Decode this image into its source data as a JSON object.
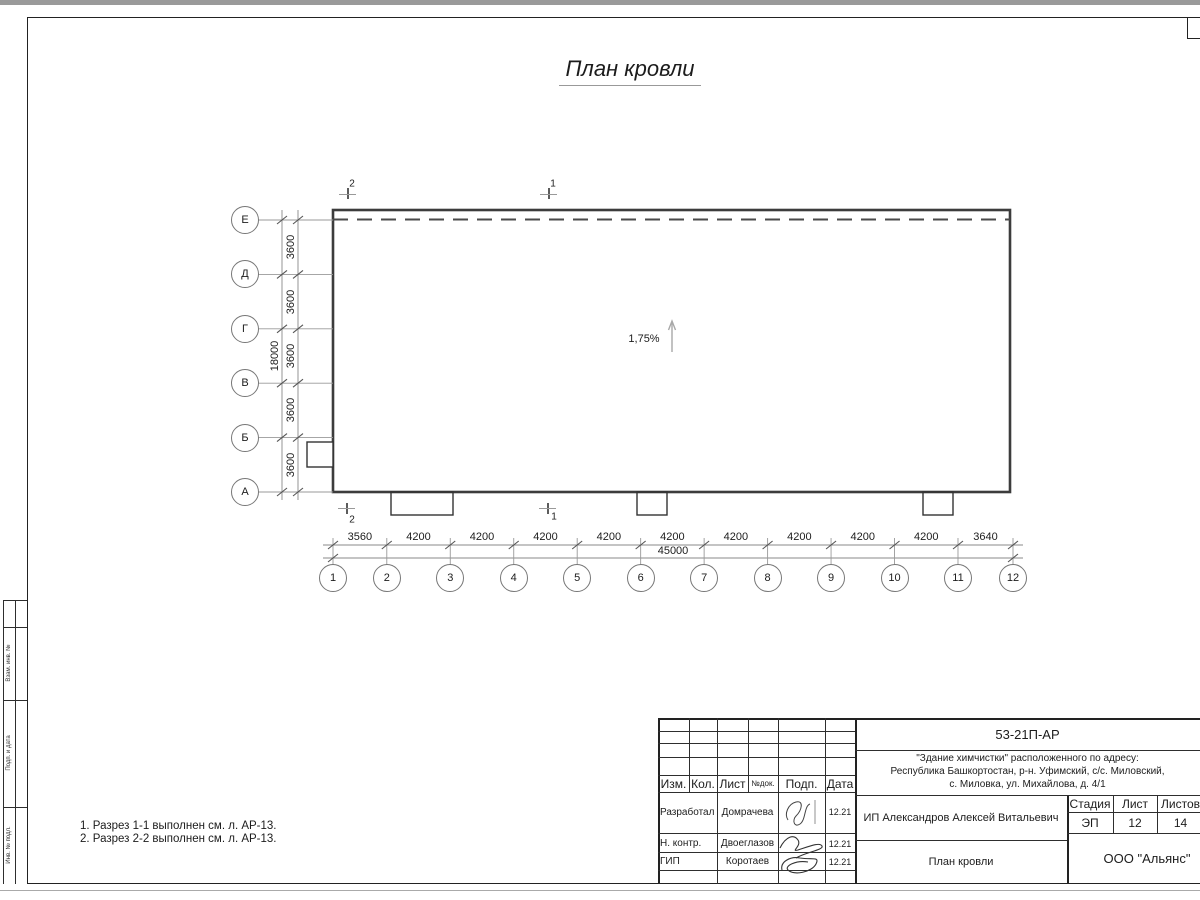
{
  "sheet": {
    "title": "План кровли",
    "notes": [
      "1. Разрез 1-1 выполнен см. л. АР-13.",
      "2. Разрез 2-2 выполнен см. л. АР-13."
    ]
  },
  "plan": {
    "slope_label": "1,75%",
    "section_top": [
      "2",
      "1"
    ],
    "section_bottom": [
      "2",
      "1"
    ],
    "row_axes": [
      "Е",
      "Д",
      "Г",
      "В",
      "Б",
      "А"
    ],
    "col_axes": [
      "1",
      "2",
      "3",
      "4",
      "5",
      "6",
      "7",
      "8",
      "9",
      "10",
      "11",
      "12"
    ],
    "row_dims": [
      "3600",
      "3600",
      "3600",
      "3600",
      "3600"
    ],
    "row_total": "18000",
    "col_dims": [
      "3560",
      "4200",
      "4200",
      "4200",
      "4200",
      "4200",
      "4200",
      "4200",
      "4200",
      "4200",
      "3640"
    ],
    "col_total": "45000"
  },
  "titleblock": {
    "doc_number": "53-21П-АР",
    "project": [
      "\"Здание химчистки\" расположенного по адресу:",
      "Республика Башкортостан, р-н. Уфимский, с/с. Миловский,",
      "с. Миловка, ул. Михайлова, д. 4/1"
    ],
    "columns": {
      "izm": "Изм.",
      "kol": "Кол.",
      "list": "Лист",
      "ndok": "№док.",
      "podp": "Подп.",
      "data": "Дата"
    },
    "rows": [
      {
        "role": "Разработал",
        "name": "Домрачева",
        "date": "12.21"
      },
      {
        "role": "Н. контр.",
        "name": "Двоеглазов",
        "date": "12.21"
      },
      {
        "role": "ГИП",
        "name": "Коротаев",
        "date": "12.21"
      }
    ],
    "client": "ИП Александров Алексей Витальевич",
    "stage_label": "Стадия",
    "sheet_label": "Лист",
    "sheets_label": "Листов",
    "stage": "ЭП",
    "sheet_no": "12",
    "sheets_total": "14",
    "drawing_title": "План кровли",
    "company": "ООО \"Альянс\""
  },
  "side_stamp": {
    "labels": [
      "Взам. инв. №",
      "Подп. и дата",
      "Инв. № подл."
    ]
  }
}
